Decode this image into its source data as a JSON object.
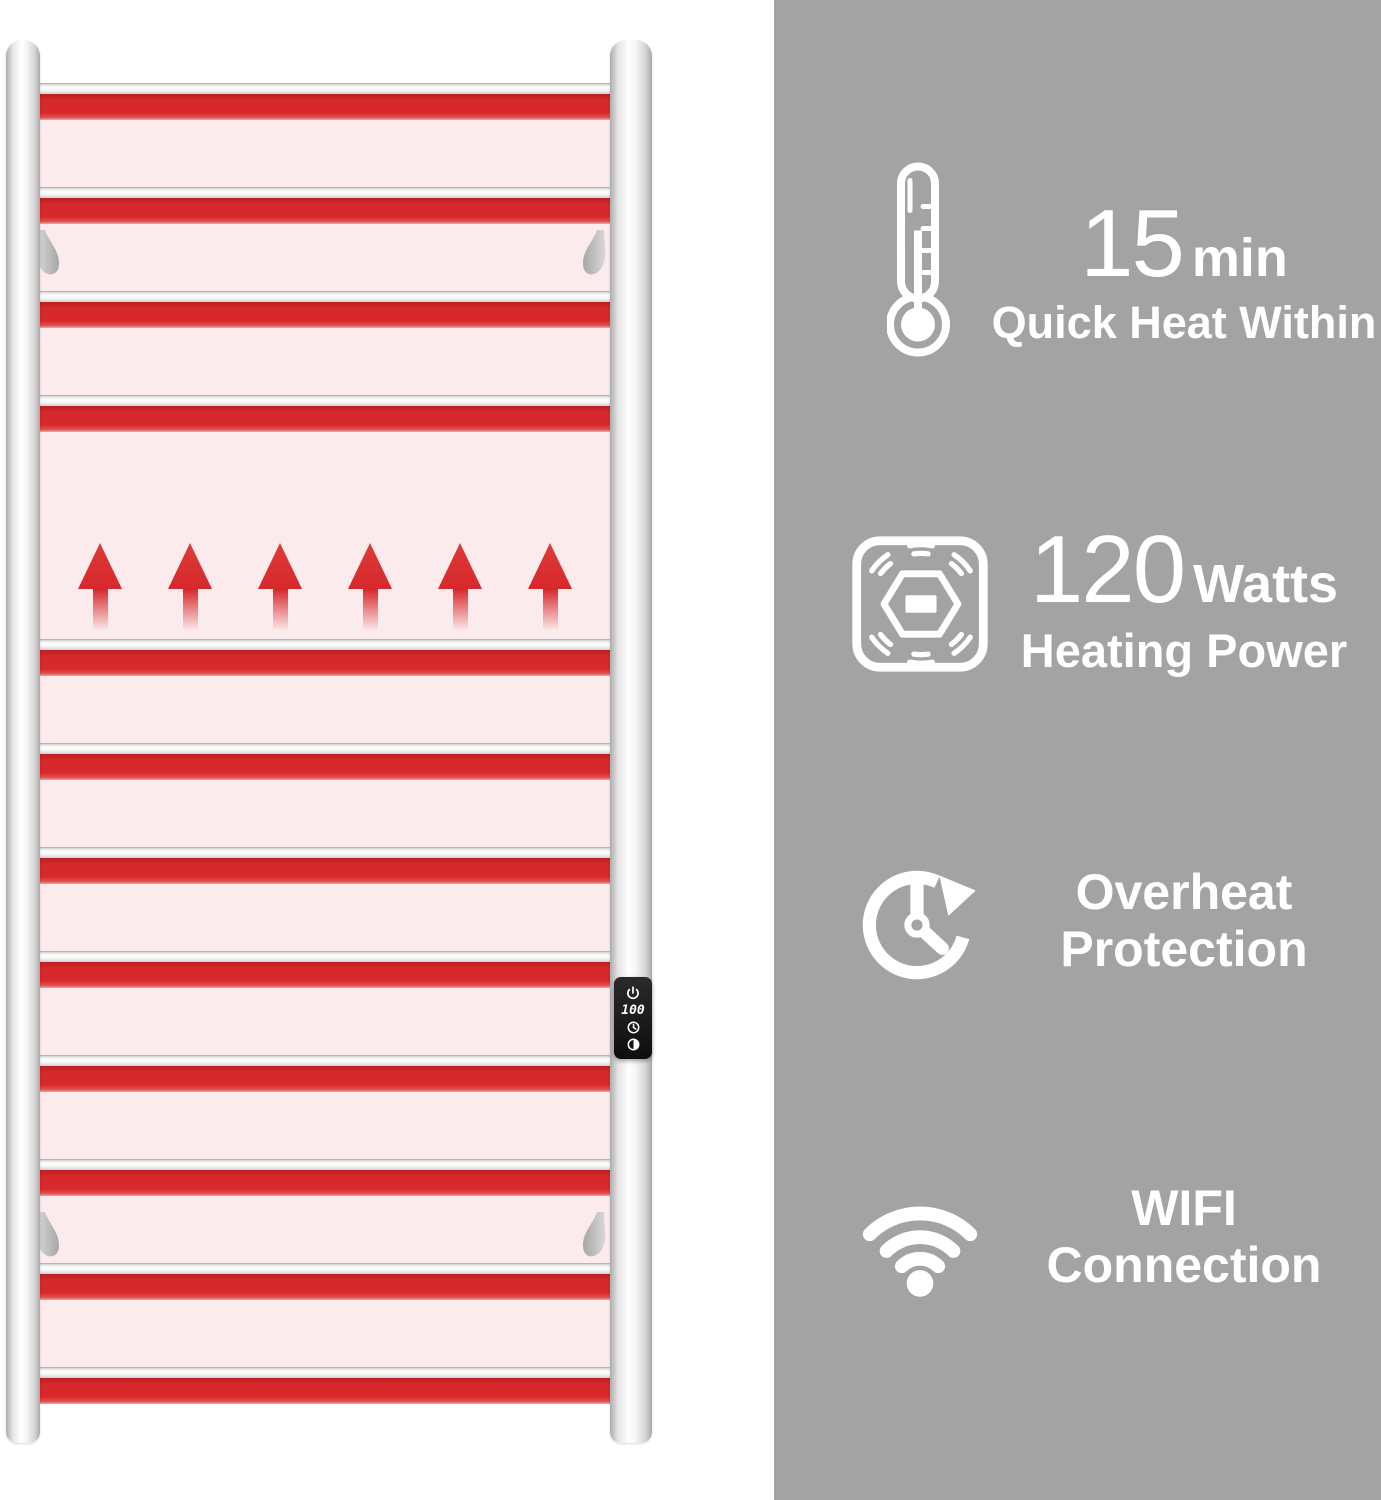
{
  "towel_warmer": {
    "control_panel": {
      "display_value": "100"
    }
  },
  "features": [
    {
      "value": "15",
      "unit": "min",
      "label": "Quick Heat Within"
    },
    {
      "value": "120",
      "unit": "Watts",
      "label": "Heating Power"
    },
    {
      "title": "Overheat",
      "subtitle": "Protection"
    },
    {
      "title": "WIFI",
      "subtitle": "Connection"
    }
  ],
  "colors": {
    "accent_red": "#d7282c",
    "glow_pink": "#fcebec",
    "panel_gray": "#a3a3a3",
    "text": "#ffffff"
  }
}
